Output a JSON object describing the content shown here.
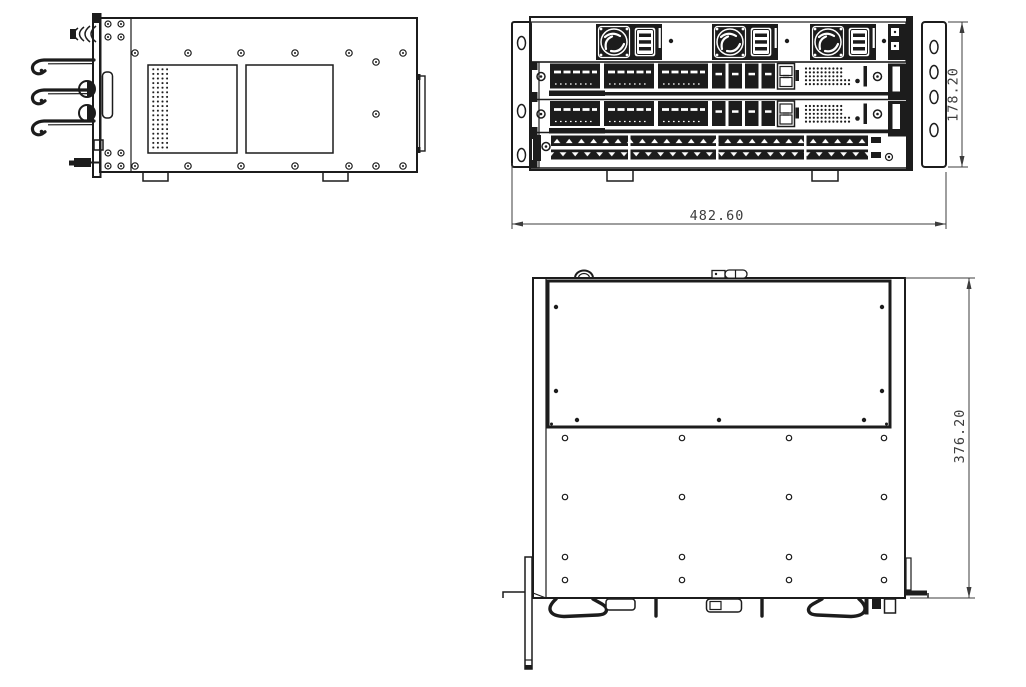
{
  "drawing": {
    "colors": {
      "background": "#ffffff",
      "ink": "#1c1c1c",
      "dim": "#3c3c3c"
    },
    "dimensions": {
      "front_width_mm": "482.60",
      "front_height_mm": "178.20",
      "top_depth_mm": "376.20"
    }
  }
}
